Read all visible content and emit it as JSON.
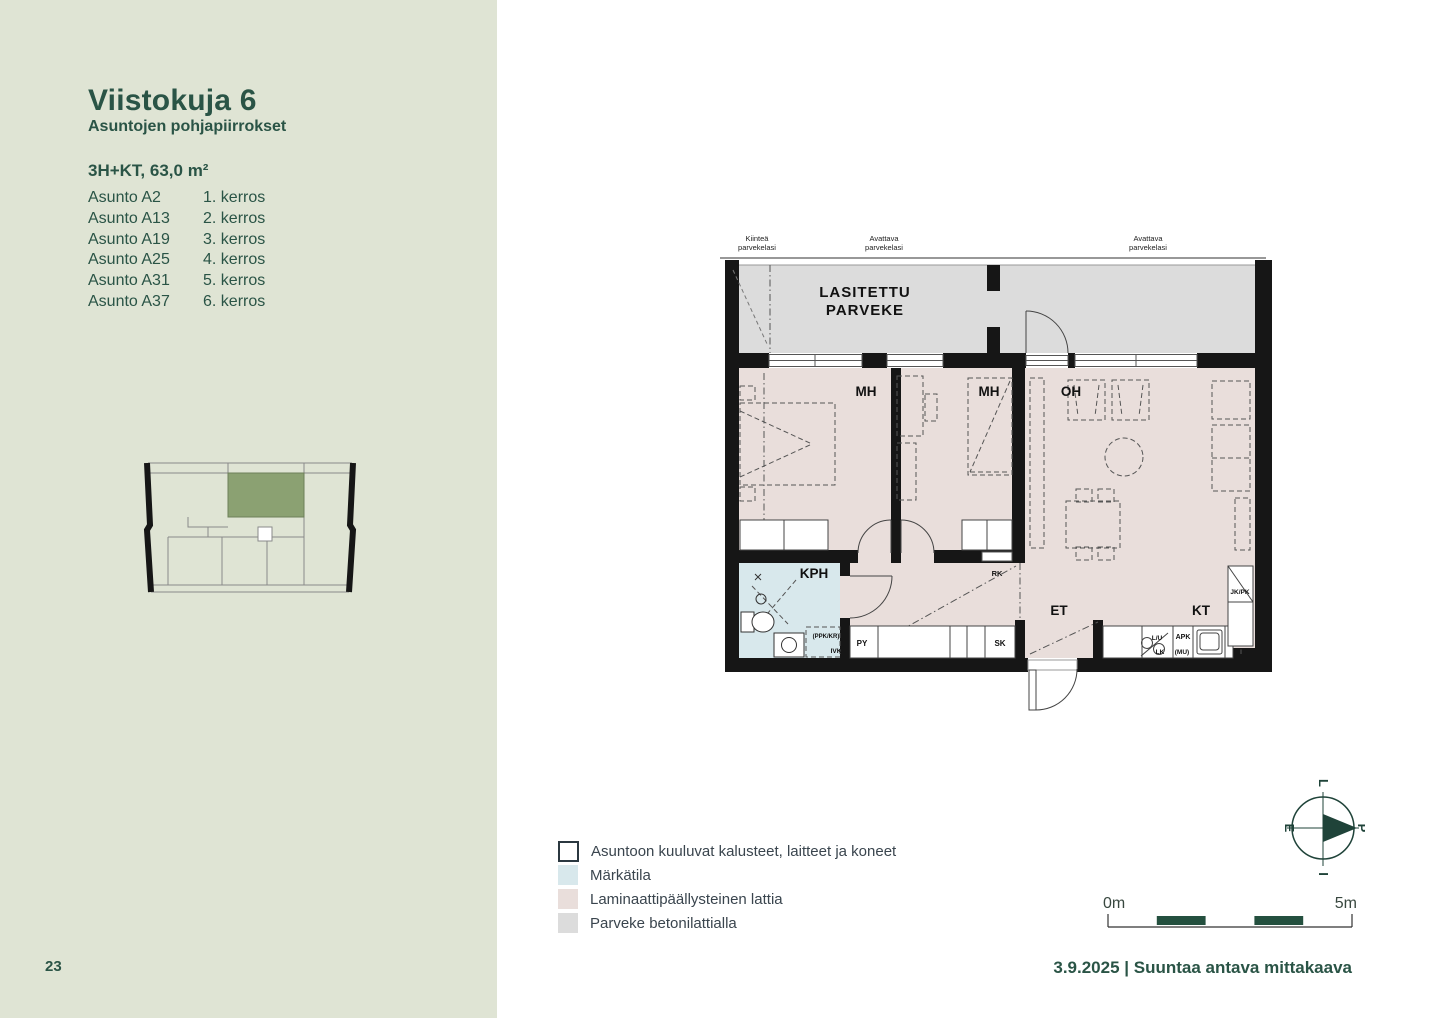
{
  "page": {
    "number": "23",
    "colors": {
      "sidebar_bg": "#dfe4d4",
      "accent_green": "#2a5446",
      "plan_black": "#161616",
      "floor_laminate": "#e9dedb",
      "floor_wet": "#d8e8ec",
      "floor_balcony": "#dcdcdc",
      "keyplan_highlight": "#8ba172",
      "legend_text": "#3a454e"
    }
  },
  "sidebar": {
    "title": "Viistokuja 6",
    "subtitle": "Asuntojen pohjapiirrokset",
    "apartment_type": "3H+KT, 63,0 m²",
    "apartments": [
      {
        "name": "Asunto A2",
        "floor": "1. kerros"
      },
      {
        "name": "Asunto A13",
        "floor": "2. kerros"
      },
      {
        "name": "Asunto A19",
        "floor": "3. kerros"
      },
      {
        "name": "Asunto A25",
        "floor": "4. kerros"
      },
      {
        "name": "Asunto A31",
        "floor": "5. kerros"
      },
      {
        "name": "Asunto A37",
        "floor": "6. kerros"
      }
    ]
  },
  "floor_plan": {
    "glazing_labels": [
      {
        "line1": "Kiinteä",
        "line2": "parvekelasi"
      },
      {
        "line1": "Avattava",
        "line2": "parvekelasi"
      },
      {
        "line1": "Avattava",
        "line2": "parvekelasi"
      }
    ],
    "balcony_line1": "LASITETTU",
    "balcony_line2": "PARVEKE",
    "rooms": {
      "mh1": "MH",
      "mh2": "MH",
      "oh": "OH",
      "kph": "KPH",
      "et": "ET",
      "kt": "KT"
    },
    "fixtures": {
      "rk": "RK",
      "py": "PY",
      "sk": "SK",
      "ppk_kr": "(PPK/KR)",
      "ivk": "IVK",
      "lu": "L/U",
      "lk": "LK",
      "apk": "APK",
      "mu": "(MU)",
      "jk_pk": "JK/PK"
    }
  },
  "legend": {
    "items": [
      {
        "label": "Asuntoon kuuluvat kalusteet, laitteet ja koneet",
        "swatch": "#ffffff",
        "outlined": true
      },
      {
        "label": "Märkätila",
        "swatch": "#d8e8ec",
        "outlined": false
      },
      {
        "label": "Laminaattipäällysteinen lattia",
        "swatch": "#e9dedb",
        "outlined": false
      },
      {
        "label": "Parveke betonilattialla",
        "swatch": "#dcdcdc",
        "outlined": false
      }
    ]
  },
  "compass": {
    "top": "L",
    "right": "P",
    "left": "E",
    "bottom": "I"
  },
  "scale_bar": {
    "start_label": "0m",
    "end_label": "5m"
  },
  "footer": {
    "date_and_note": "3.9.2025 | Suuntaa antava mittakaava"
  }
}
